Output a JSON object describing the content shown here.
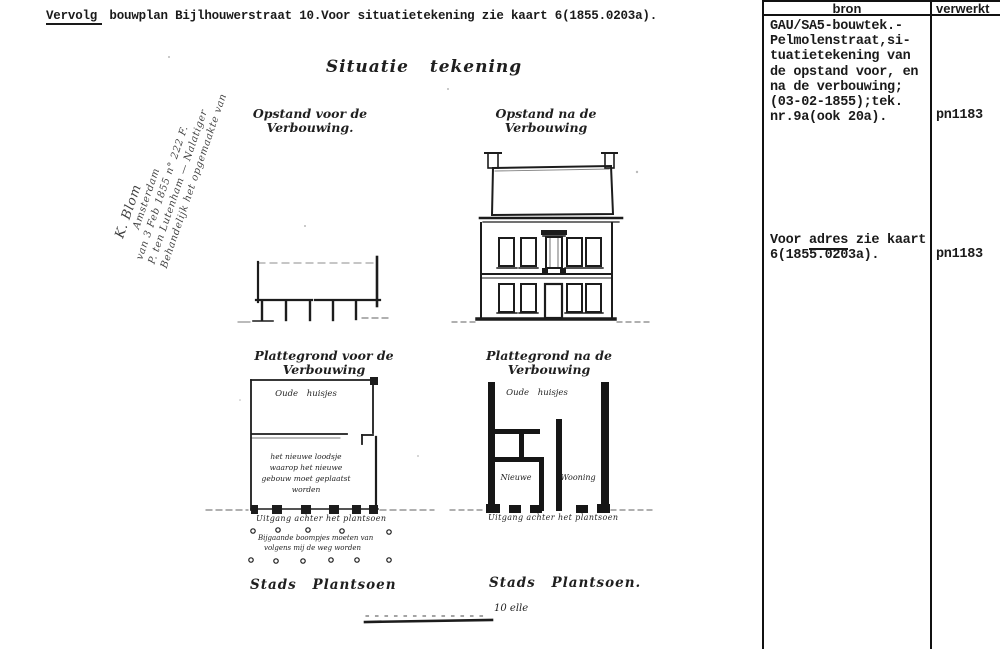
{
  "header": {
    "title_underlined": "Vervolg",
    "title_rest": " bouwplan Bijlhouwerstraat 10.Voor situatietekening zie kaart 6(1855.0203a)."
  },
  "handwritten_note": {
    "lines": [
      "Behandelijk het opgemaakte van",
      "P. ten Lutenham — Nalatiger",
      "van 3 Feb 1855 n° 222 F.",
      "Amsterdam",
      "K. Blom"
    ]
  },
  "drawing": {
    "title": "Situatie tekening",
    "elevation_before_label": [
      "Opstand voor de",
      "Verbouwing."
    ],
    "elevation_after_label": [
      "Opstand na de",
      "Verbouwing"
    ],
    "plan_before_label": [
      "Plattegrond voor de",
      "Verbouwing"
    ],
    "plan_after_label": [
      "Plattegrond na de",
      "Verbouwing"
    ],
    "plan_before": {
      "room_top": "Oude huisjes",
      "note_lines": [
        "het nieuwe loodsje",
        "waarop het nieuwe",
        "gebouw moet geplaatst",
        "worden"
      ],
      "exit_label": "Uitgang achter het plantsoen"
    },
    "plan_after": {
      "room_top": "Oude huisjes",
      "room_left": "Nieuwe",
      "room_right": "Wooning",
      "exit_label": "Uitgang achter het plantsoen"
    },
    "trees_note": [
      "Bijgaande boompjes moeten van",
      "volgens mij de weg worden"
    ],
    "plantsoen_left": "Stads Plantsoen",
    "plantsoen_right": "Stads Plantsoen.",
    "scale_label": "10 elle"
  },
  "table": {
    "col_bron": "bron",
    "col_verwerkt": "verwerkt",
    "row1": {
      "lines": [
        "GAU/SA5-bouwtek.-",
        "Pelmolenstraat,si-",
        "tuatietekening van",
        "de opstand voor, en",
        "na de verbouwing;",
        "(03-02-1855);tek.",
        "nr.9a(ook 20a)."
      ],
      "verwerkt": "pn1183"
    },
    "row2": {
      "prefix": "Voor ",
      "underlined": "adres",
      "suffix": " zie kaart",
      "line2": "6(1855.0203a).",
      "verwerkt": "pn1183"
    }
  },
  "colors": {
    "ink": "#1a1a1a",
    "paper": "#ffffff"
  }
}
